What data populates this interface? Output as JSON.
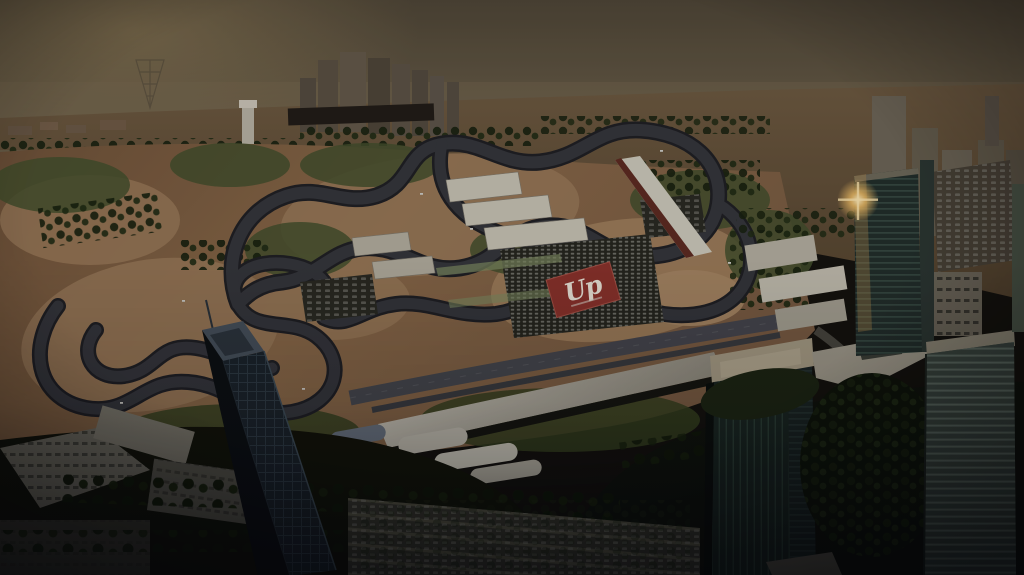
{
  "meta": {
    "description": "Darkened aerial architectural rendering of a motorsport-city development at hazy dusk: a winding race circuit on sandy ground with paddock buildings and packed car parks, a red plaza bearing a white script Up logo, palm-lined boulevards, and tall glass towers in the foreground with a sun glint on the right tower"
  },
  "scene": {
    "branding": {
      "logo_text": "Up"
    },
    "colors": {
      "sky_top": "#4f4737",
      "sky_mid": "#6b6049",
      "sky_horizon": "#7b6e53",
      "sun_glow": "#97835a",
      "desert_far": "#6e5b41",
      "desert_deep": "#55452f",
      "sand_dark": "#6f5339",
      "sand_mid": "#8a6a49",
      "sand_light": "#95744f",
      "asphalt": "#35373c",
      "asphalt_edge": "#1f2024",
      "straight_road": "#46484e",
      "service_road": "#55544b",
      "verge_green": "#44512d",
      "tree_dark": "#1a2410",
      "roof_white": "#c9c5b5",
      "grandstand_roof": "#d2cec0",
      "plaza_red": "#8c342c",
      "logo_white": "#efe9dc",
      "glass_dark": "#0c1013",
      "glass_teal": "#222f2b",
      "glass_green": "#1a2722",
      "glass_striped": "#3a463f",
      "tower_crown": "#a99f87",
      "podium_roof": "#a29d8d",
      "glint_gold": "#f6c469"
    }
  }
}
